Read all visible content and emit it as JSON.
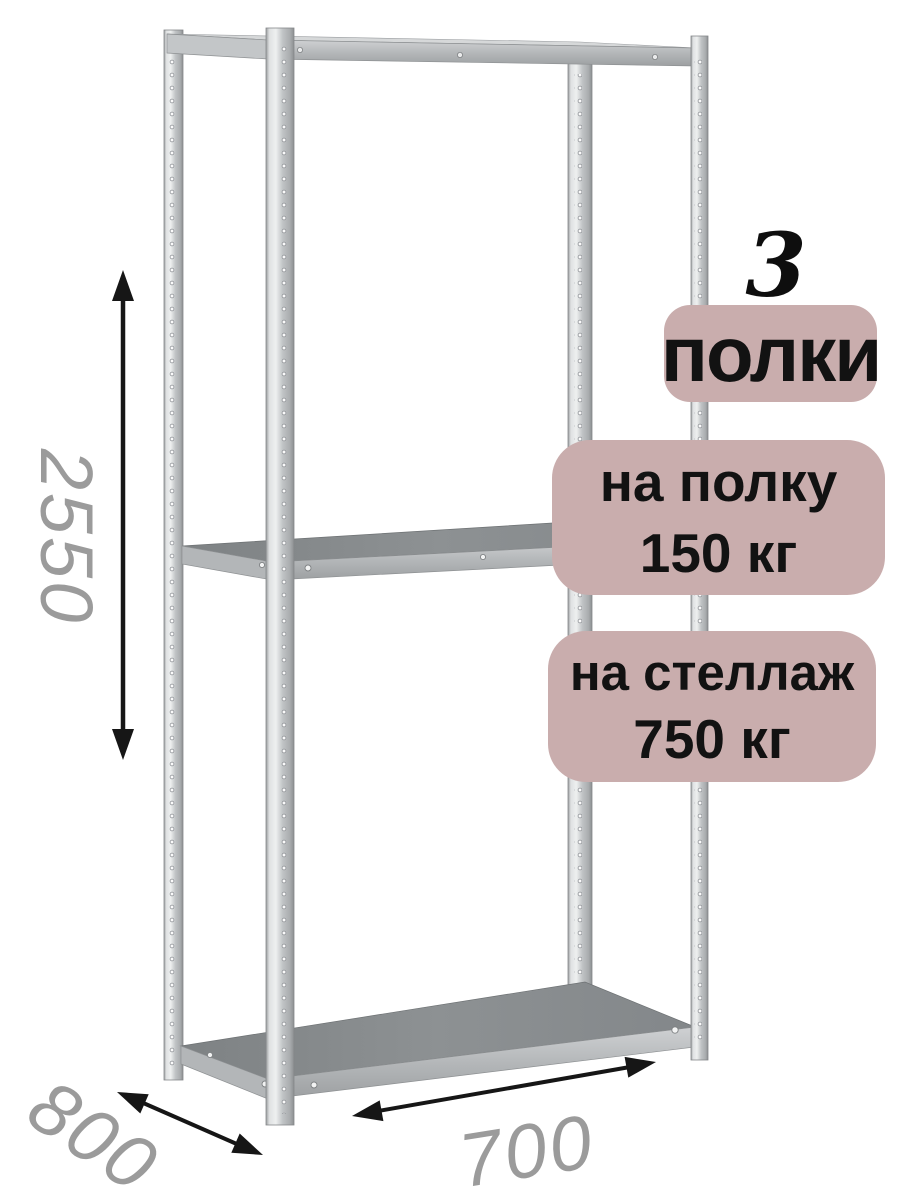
{
  "product": {
    "shelf_count": "3",
    "shelf_count_label": "полки",
    "per_shelf_load": {
      "line1": "на полку",
      "line2": "150 кг"
    },
    "total_load": {
      "line1": "на стеллаж",
      "line2": "750 кг"
    }
  },
  "dimensions": {
    "height": "2550",
    "depth": "800",
    "width": "700"
  },
  "colors": {
    "badge_bg": "#c9adad",
    "badge_text": "#121212",
    "dimension_text": "#9b9b9b",
    "arrow": "#161616",
    "metal_light": "#e6e8e9",
    "metal_mid": "#bcbfc1",
    "metal_dark": "#8f9294",
    "shelf_deck": "#8a8e90"
  }
}
